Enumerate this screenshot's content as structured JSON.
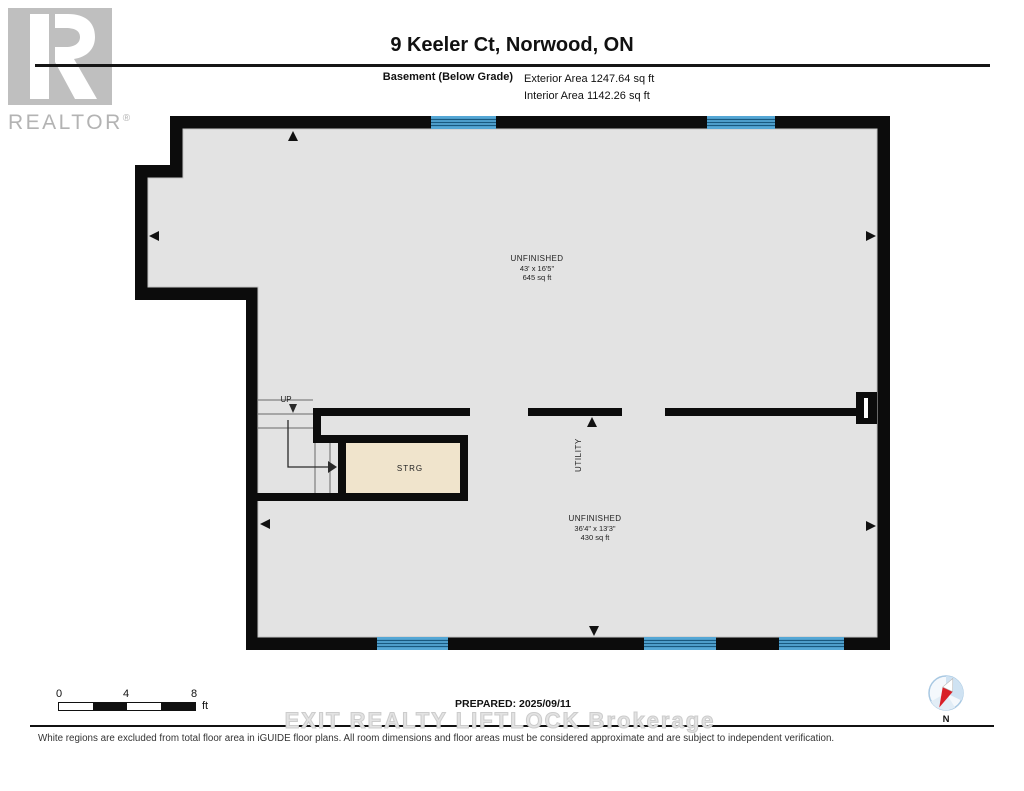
{
  "header": {
    "logo": {
      "brand": "REALTOR",
      "registered": "®"
    },
    "title": "9 Keeler Ct, Norwood, ON",
    "floor_label": "Basement (Below Grade)",
    "exterior_area": "Exterior Area 1247.64 sq ft",
    "interior_area": "Interior Area 1142.26 sq ft"
  },
  "plan": {
    "rooms": {
      "unfinished_upper": {
        "name": "UNFINISHED",
        "dimensions": "43' x 16'5\"",
        "area": "645 sq ft"
      },
      "unfinished_lower": {
        "name": "UNFINISHED",
        "dimensions": "36'4\" x 13'3\"",
        "area": "430 sq ft"
      },
      "storage": {
        "name": "STRG"
      },
      "utility": {
        "name": "UTILITY"
      }
    },
    "stairs": {
      "label": "UP"
    },
    "colors": {
      "wall": "#0c0c0c",
      "floor": "#e3e3e3",
      "storage_floor": "#f0e4cc",
      "window_blue": "#55a7d5",
      "window_line": "#19597f",
      "compass_red": "#d81f26"
    }
  },
  "footer": {
    "scale_bar": {
      "ticks": [
        "0",
        "4",
        "8"
      ],
      "unit": "ft"
    },
    "prepared": "PREPARED: 2025/09/11",
    "watermark": "EXIT REALTY LIFTLOCK Brokerage",
    "compass": {
      "label": "N"
    },
    "disclaimer": "White regions are excluded from total floor area in iGUIDE floor plans. All room dimensions and floor areas must be considered approximate and are subject to independent verification."
  }
}
